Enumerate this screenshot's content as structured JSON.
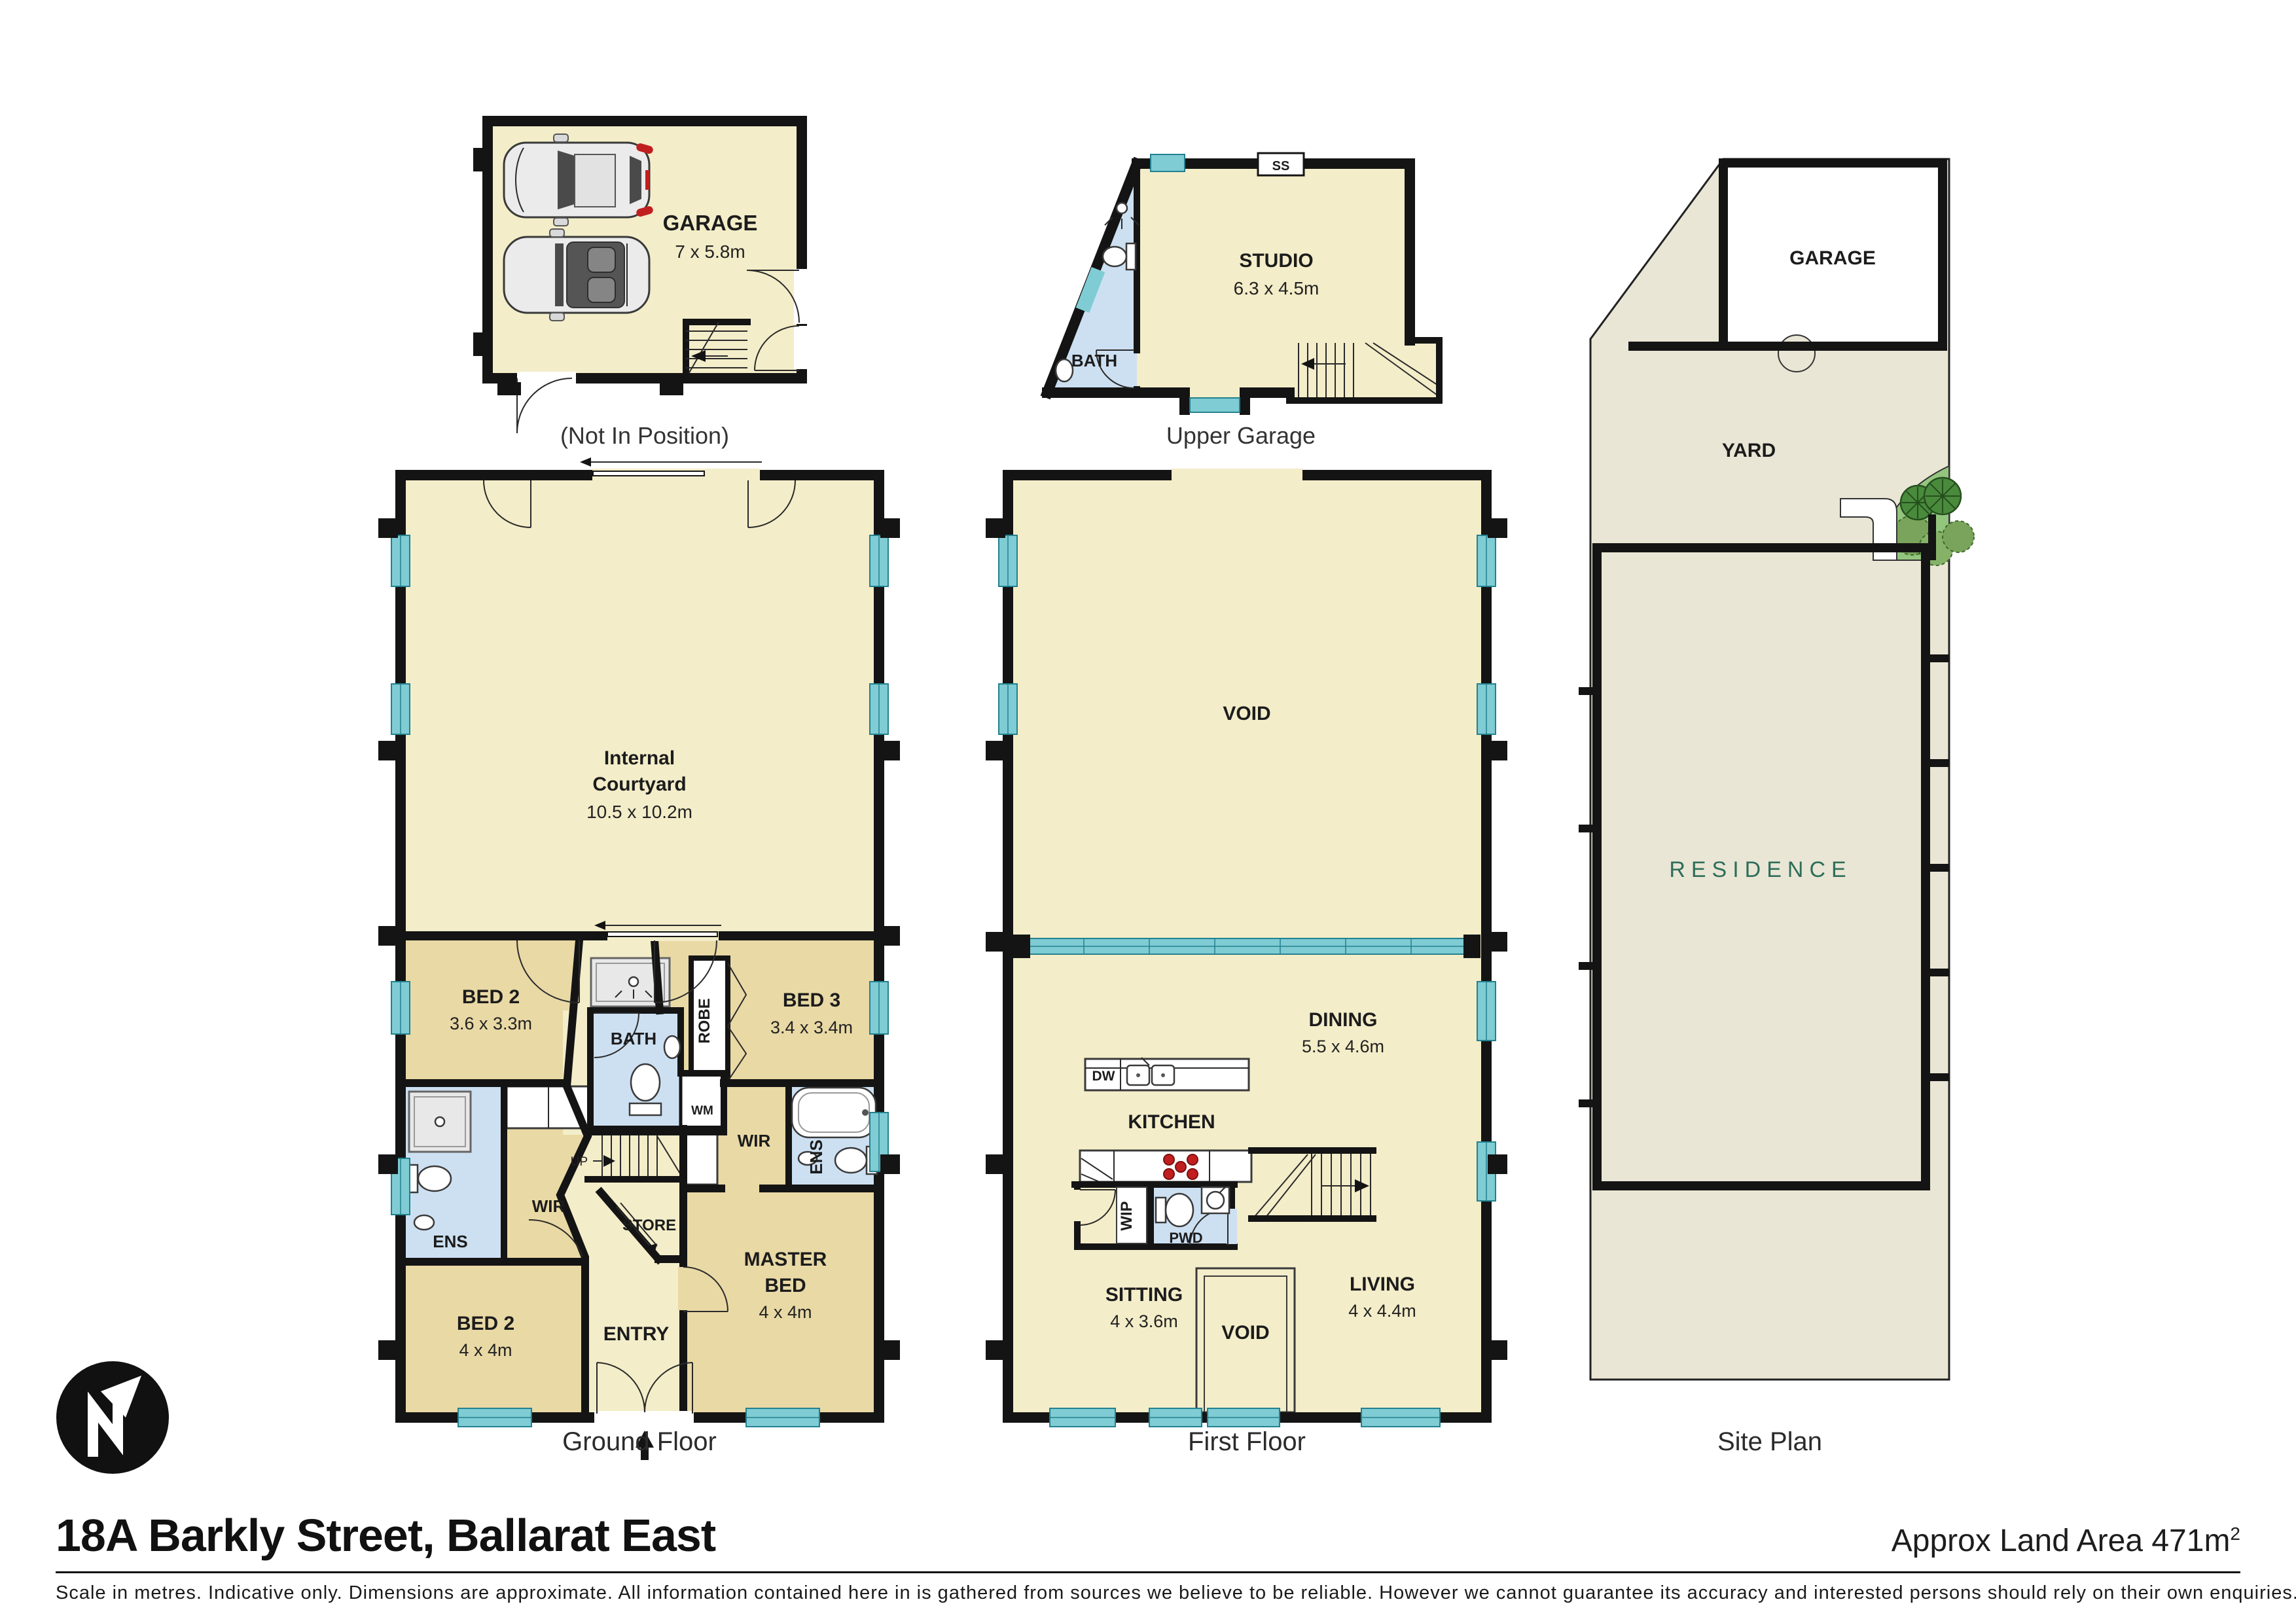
{
  "header": {
    "title": "18A Barkly Street, Ballarat East",
    "land_area": "Approx Land Area 471m",
    "land_area_sup": "2"
  },
  "footer": {
    "disclaimer": "Scale in metres. Indicative only. Dimensions are approximate. All information contained here in is gathered from sources we believe to be reliable. However we cannot guarantee its accuracy and interested persons should rely on their own enquiries."
  },
  "captions": {
    "garage": "(Not In Position)",
    "upper_garage": "Upper Garage",
    "ground": "Ground Floor",
    "first": "First Floor",
    "site": "Site Plan"
  },
  "garage_plan": {
    "name": "GARAGE",
    "dims": "7 x 5.8m"
  },
  "upper_garage_plan": {
    "studio": "STUDIO",
    "studio_dims": "6.3 x 4.5m",
    "bath": "BATH",
    "ss": "SS"
  },
  "ground_plan": {
    "courtyard_line1": "Internal",
    "courtyard_line2": "Courtyard",
    "courtyard_dims": "10.5 x 10.2m",
    "bed2a": "BED 2",
    "bed2a_dims": "3.6 x 3.3m",
    "bed3": "BED 3",
    "bed3_dims": "3.4 x 3.4m",
    "robe": "ROBE",
    "bath": "BATH",
    "wm": "WM",
    "up": "UP",
    "wir_left": "WIR",
    "wir_right": "WIR",
    "ens_left": "ENS",
    "ens_right": "ENS",
    "store": "STORE",
    "bed2b": "BED 2",
    "bed2b_dims": "4 x 4m",
    "entry": "ENTRY",
    "master_line1": "MASTER",
    "master_line2": "BED",
    "master_dims": "4 x 4m"
  },
  "first_plan": {
    "void_main": "VOID",
    "dining": "DINING",
    "dining_dims": "5.5 x 4.6m",
    "kitchen": "KITCHEN",
    "dw": "DW",
    "wip": "WIP",
    "pwd": "PWD",
    "sitting": "SITTING",
    "sitting_dims": "4 x 3.6m",
    "void_small": "VOID",
    "living": "LIVING",
    "living_dims": "4 x 4.4m"
  },
  "site_plan": {
    "garage": "GARAGE",
    "yard": "YARD",
    "residence": "RESIDENCE"
  },
  "north": {
    "label": "N"
  },
  "colors": {
    "wall": "#141414",
    "room_cream": "#f3edc9",
    "room_tan": "#e9d9a5",
    "room_blue": "#cde0f2",
    "window_teal": "#7fccd4",
    "window_edge": "#23818f",
    "yard": "#e9e6d5",
    "garden_green": "#94c57e",
    "tree_green": "#4a8a3c",
    "residence_label": "#2e6e5a",
    "burner_red": "#c11f1f"
  }
}
